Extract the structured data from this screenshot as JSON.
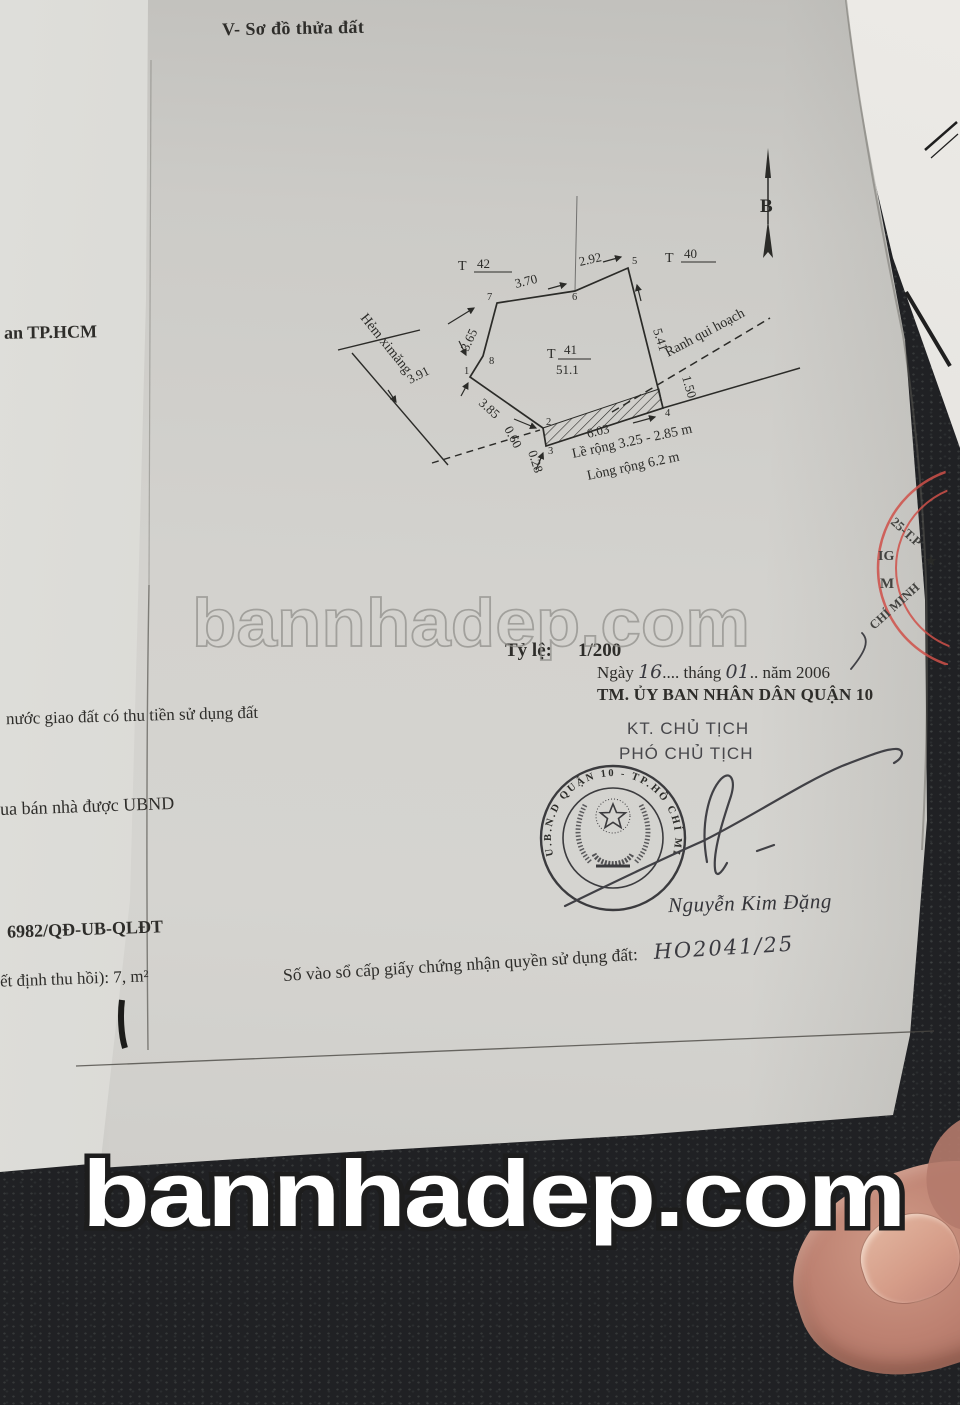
{
  "page": {
    "title": "V- Sơ đồ thửa đất"
  },
  "diagram": {
    "north_label": "B",
    "plot": {
      "prefix": "T",
      "number": "41",
      "area": "51.1"
    },
    "neighbor_left": {
      "prefix": "T",
      "number": "42"
    },
    "neighbor_right": {
      "prefix": "T",
      "number": "40"
    },
    "vertices": [
      "1",
      "2",
      "3",
      "4",
      "5",
      "6",
      "7",
      "8"
    ],
    "measurements": {
      "edge_7_6": "3.70",
      "edge_6_5": "2.92",
      "edge_5_4": "5.41",
      "edge_8_7": "3.65",
      "edge_1_2": "3.85",
      "edge_2_a": "0.60",
      "edge_b_3": "0.28",
      "edge_3_4": "6.03",
      "setback": "1.50",
      "alley_width": "3.91"
    },
    "alley_label": "Hẻm ximăng",
    "planning_boundary_label": "Ranh qui hoạch",
    "sidewalk_note": "Lề rộng 3.25 - 2.85 m",
    "road_note": "Lòng rộng 6.2 m"
  },
  "scale": {
    "label": "Tỷ lệ:",
    "value": "1/200"
  },
  "date": {
    "day_label": "Ngày",
    "day": "16",
    "dots_1": "....",
    "month_label": "tháng",
    "month": "01",
    "dots_2": "..",
    "year_label": "năm",
    "year": "2006"
  },
  "authority": {
    "issuer": "TM. ỦY BAN NHÂN DÂN QUẬN 10",
    "deputy_for": "KT. CHỦ TỊCH",
    "signer_title": "PHÓ CHỦ TỊCH",
    "signer_name": "Nguyễn Kim Đặng"
  },
  "seal": {
    "ring_text": "U.B.N.D QUẬN 10  -  TP.HỒ CHÍ MINH"
  },
  "red_seal": {
    "arc_top": "25-T.P",
    "star": "★",
    "inner_line_1": "IG",
    "inner_line_2": "M",
    "arc_bottom": "CHÍ MINH",
    "color": "#cf5049"
  },
  "registry": {
    "label": "Số vào sổ cấp giấy chứng nhận quyền sử dụng đất:",
    "value": "HO2041/25"
  },
  "left_edge_fragments": [
    "an TP.HCM",
    "nước giao đất có thu tiền sử dụng đất",
    "ua bán nhà được UBND",
    "6982/QĐ-UB-QLĐT",
    "ết định thu hồi): 7, m²"
  ],
  "watermarks": {
    "center": "bannhadep.com",
    "bottom": "bannhadep.com"
  }
}
